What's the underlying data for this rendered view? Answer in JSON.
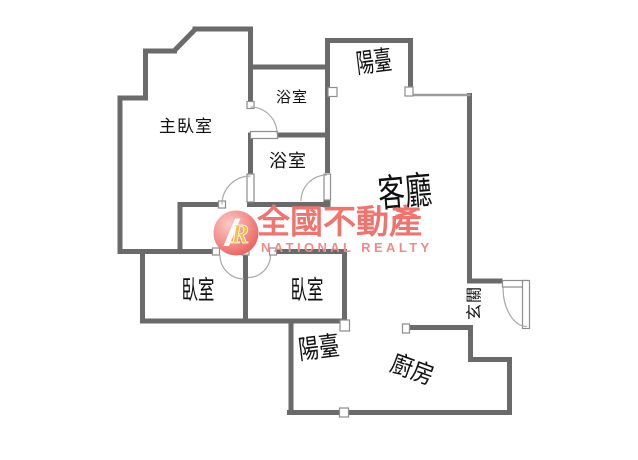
{
  "rooms": [
    {
      "id": "master-bedroom",
      "label": "主臥室"
    },
    {
      "id": "bathroom-upper",
      "label": "浴室"
    },
    {
      "id": "bathroom-lower",
      "label": "浴室"
    },
    {
      "id": "balcony-top",
      "label": "陽臺"
    },
    {
      "id": "living-room",
      "label": "客廳"
    },
    {
      "id": "bedroom-left",
      "label": "臥室"
    },
    {
      "id": "bedroom-right",
      "label": "臥室"
    },
    {
      "id": "balcony-bottom",
      "label": "陽臺"
    },
    {
      "id": "kitchen",
      "label": "廚房"
    },
    {
      "id": "foyer",
      "label": "玄關"
    }
  ],
  "watermark": {
    "monogram": "R",
    "title": "全國不動產",
    "subtitle": "NATIONAL REALTY",
    "brand_color": "#ee7470"
  },
  "colors": {
    "wall": "#6a6a6a",
    "arc": "#a9a9a9",
    "background": "#ffffff"
  }
}
